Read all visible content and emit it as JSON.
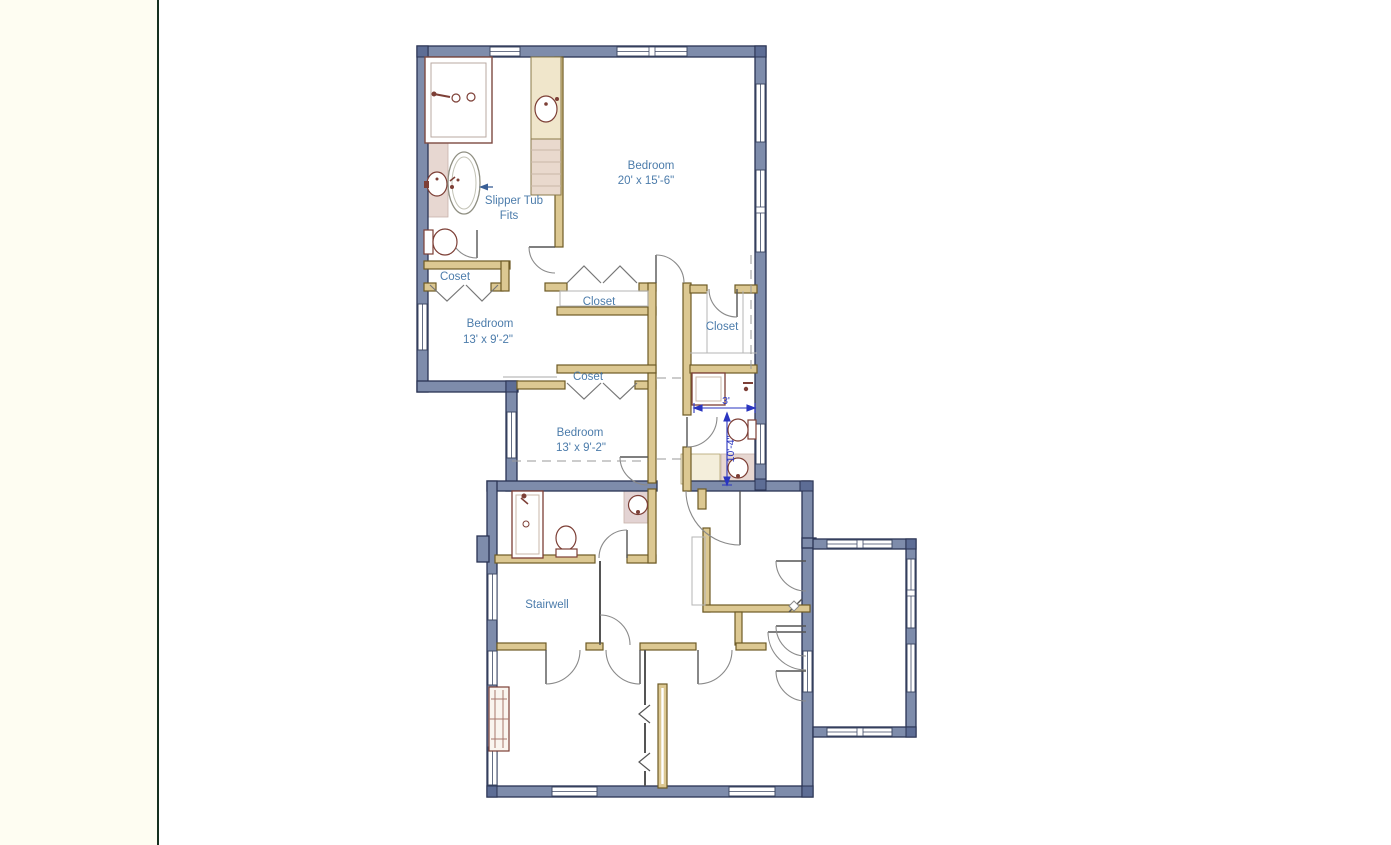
{
  "window": {
    "background": "#ffffff",
    "margin_color": "#fefdf2",
    "separator_color": "#16301f"
  },
  "floorplan": {
    "rooms": {
      "bedroom_master": {
        "label": "Bedroom",
        "dimensions": "20' x 15'-6\""
      },
      "bedroom_west": {
        "label": "Bedroom",
        "dimensions": "13' x 9'-2\""
      },
      "bedroom_center": {
        "label": "Bedroom",
        "dimensions": "13' x 9'-2\""
      },
      "stairwell": {
        "label": "Stairwell"
      }
    },
    "closets": {
      "closet_nw": "Coset",
      "closet_center": "Closet",
      "closet_east": "Closet",
      "closet_mid": "Coset"
    },
    "annotations": {
      "slipper_tub_line1": "Slipper Tub",
      "slipper_tub_line2": "Fits"
    },
    "dimensions": {
      "bath_width": "3'",
      "bath_length": "10'-4\""
    },
    "colors": {
      "exterior_wall": "#7e8cab",
      "interior_wall": "#dcc892",
      "fixture_outline": "#7d3f36",
      "bath_floor": "#e7d7d1",
      "label_text": "#4c7cab",
      "dimension_text": "#2a35c0"
    }
  }
}
